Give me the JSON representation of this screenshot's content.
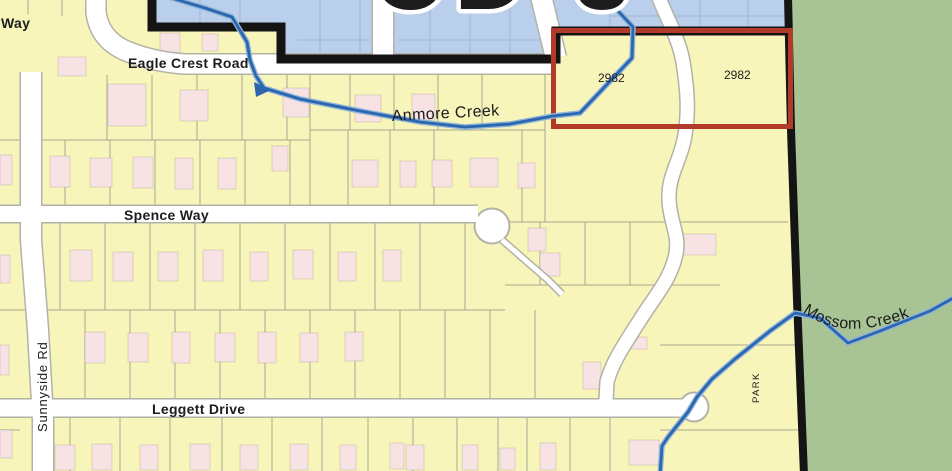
{
  "map": {
    "zone_label": "CD 3",
    "parcel_labels": {
      "left": "2982",
      "right": "2982"
    },
    "park_label": "PARK",
    "roads": {
      "eagle_crest": "Eagle Crest Road",
      "spence": "Spence Way",
      "leggett": "Leggett Drive",
      "sunnyside": "Sunnyside Rd",
      "way_partial": "Way"
    },
    "creeks": {
      "anmore": "Anmore Creek",
      "mossom": "Mossom Creek"
    },
    "colors": {
      "parcel_fill": "#f8f5ba",
      "park_green": "#a8c495",
      "cd_zone_blue": "#b9cfeb",
      "cd_grid_blue": "#9fb6d6",
      "building_pink": "#f7e2e4",
      "road_white": "#ffffff",
      "road_casing": "#b2b2a6",
      "lot_line": "#a8a88e",
      "creek_blue": "#2b66ae",
      "creek_halo": "#8fb4da",
      "boundary_black": "#141414",
      "highlight_red": "#b23a28",
      "label_color": "#1c1c1c",
      "halo_white": "#ffffff"
    },
    "buildings": [
      [
        160,
        33,
        20,
        20
      ],
      [
        202,
        34,
        16,
        17
      ],
      [
        58,
        57,
        28,
        19
      ],
      [
        108,
        84,
        38,
        42
      ],
      [
        180,
        90,
        28,
        31
      ],
      [
        283,
        88,
        26,
        29
      ],
      [
        355,
        95,
        26,
        27
      ],
      [
        412,
        94,
        23,
        26
      ],
      [
        50,
        156,
        20,
        31
      ],
      [
        90,
        158,
        22,
        29
      ],
      [
        133,
        157,
        20,
        31
      ],
      [
        175,
        158,
        18,
        31
      ],
      [
        218,
        158,
        18,
        31
      ],
      [
        272,
        146,
        16,
        25
      ],
      [
        352,
        160,
        26,
        27
      ],
      [
        400,
        161,
        16,
        26
      ],
      [
        432,
        160,
        20,
        27
      ],
      [
        470,
        158,
        28,
        29
      ],
      [
        518,
        163,
        17,
        25
      ],
      [
        70,
        250,
        22,
        31
      ],
      [
        113,
        252,
        20,
        29
      ],
      [
        158,
        252,
        20,
        29
      ],
      [
        203,
        250,
        20,
        31
      ],
      [
        250,
        252,
        18,
        29
      ],
      [
        293,
        250,
        20,
        29
      ],
      [
        338,
        252,
        18,
        29
      ],
      [
        383,
        250,
        18,
        31
      ],
      [
        528,
        228,
        18,
        23
      ],
      [
        680,
        234,
        36,
        21
      ],
      [
        540,
        253,
        20,
        23
      ],
      [
        85,
        332,
        20,
        31
      ],
      [
        128,
        333,
        20,
        29
      ],
      [
        172,
        332,
        18,
        31
      ],
      [
        215,
        333,
        20,
        29
      ],
      [
        258,
        332,
        18,
        31
      ],
      [
        300,
        333,
        18,
        29
      ],
      [
        345,
        332,
        18,
        29
      ],
      [
        583,
        362,
        18,
        27
      ],
      [
        627,
        337,
        20,
        12
      ],
      [
        92,
        444,
        20,
        26
      ],
      [
        140,
        445,
        18,
        25
      ],
      [
        190,
        444,
        20,
        26
      ],
      [
        240,
        445,
        18,
        25
      ],
      [
        290,
        444,
        18,
        26
      ],
      [
        340,
        445,
        16,
        25
      ],
      [
        390,
        443,
        14,
        26
      ],
      [
        406,
        445,
        18,
        25
      ],
      [
        462,
        445,
        16,
        25
      ],
      [
        500,
        448,
        15,
        22
      ],
      [
        540,
        443,
        16,
        27
      ],
      [
        629,
        440,
        30,
        25
      ],
      [
        55,
        445,
        20,
        25
      ],
      [
        0,
        155,
        12,
        30
      ],
      [
        0,
        255,
        10,
        28
      ],
      [
        0,
        345,
        9,
        30
      ],
      [
        0,
        430,
        12,
        28
      ]
    ]
  }
}
